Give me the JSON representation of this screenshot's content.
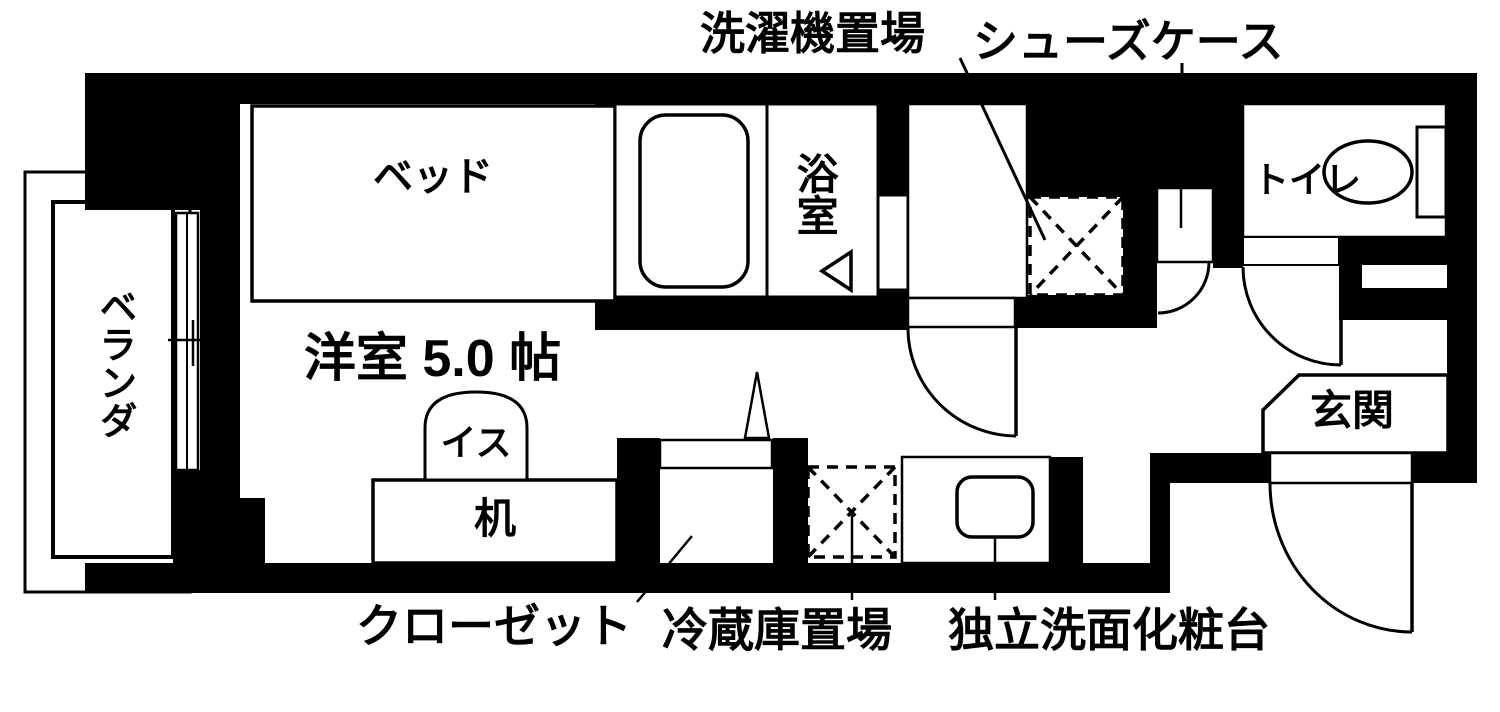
{
  "floorplan": {
    "title": "ワンルーム間取り図",
    "labels": {
      "washer_area": "洗濯機置場",
      "shoe_case": "シューズケース",
      "bed": "ベッド",
      "bathroom": "浴室",
      "toilet": "トイレ",
      "veranda": "ベランダ",
      "main_room": "洋室 5.0 帖",
      "chair": "イス",
      "desk": "机",
      "entrance": "玄関",
      "closet": "クローゼット",
      "fridge_area": "冷蔵庫置場",
      "vanity": "独立洗面化粧台"
    },
    "room_size_joh": "5.0",
    "colors": {
      "wall": "#000000",
      "floor": "#ffffff",
      "line": "#000000"
    }
  }
}
